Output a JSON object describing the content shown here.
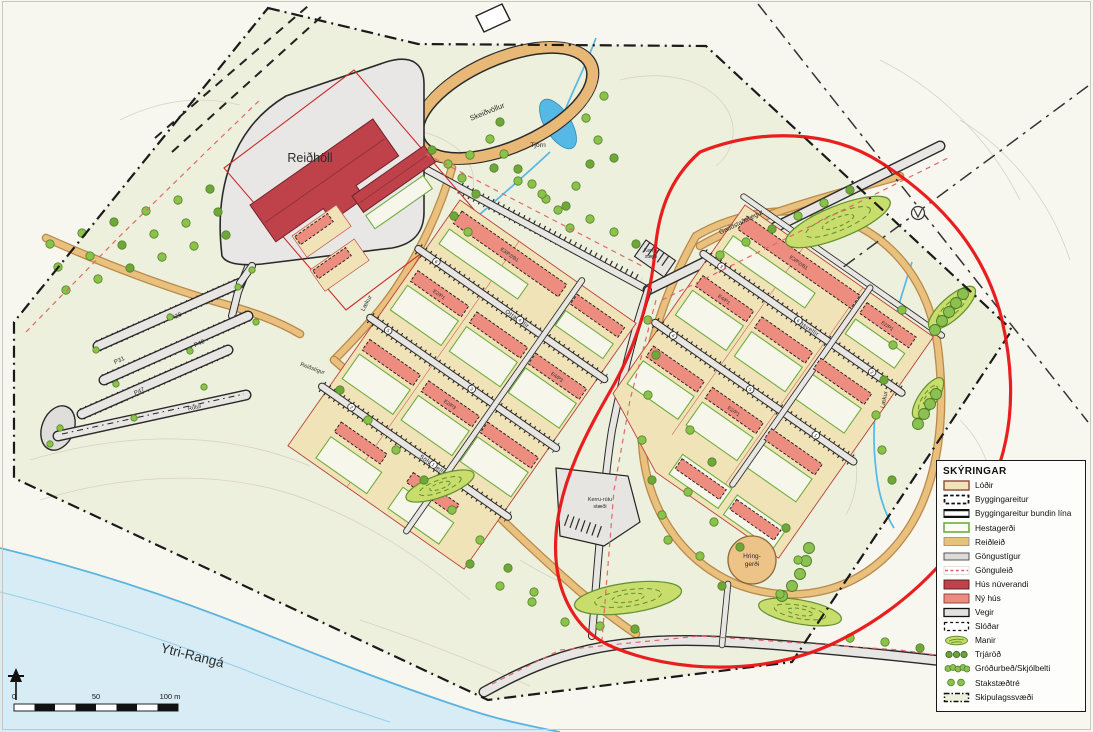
{
  "legend": {
    "title": "SKÝRINGAR",
    "items": [
      {
        "label": "Lóðir"
      },
      {
        "label": "Byggingareitur"
      },
      {
        "label": "Byggingareitur bundin lína"
      },
      {
        "label": "Hestagerði"
      },
      {
        "label": "Reiðleið"
      },
      {
        "label": "Göngustígur"
      },
      {
        "label": "Gönguleið"
      },
      {
        "label": "Hús núverandi"
      },
      {
        "label": "Ný hús"
      },
      {
        "label": "Vegir"
      },
      {
        "label": "Slóðar"
      },
      {
        "label": "Manir"
      },
      {
        "label": "Trjáröð"
      },
      {
        "label": "Gróðurbeð/Skjólbelti"
      },
      {
        "label": "Stakstæðtré"
      },
      {
        "label": "Skipulagssvæði"
      }
    ]
  },
  "map": {
    "labels": {
      "reidholl": "Reiðhöll",
      "skeidvollur": "Skeiðvöllur",
      "tjorn": "Tjörn",
      "river": "Ytri-Rangá",
      "laekur_west": "Lækur",
      "laekur_east": "Lækur",
      "hringgerdi_l1": "Hring-",
      "hringgerdi_l2": "gerði",
      "kerru_l1": "Kerru-",
      "kerru_l2": "stæði",
      "kerru_rutu_l1": "Kerru-rútu",
      "kerru_rutu_l2": "stæði",
      "main_road": "Gaddstaðavegur",
      "street_central_upper": "Ottavellir",
      "street_central_lower": "Sölvavellir",
      "street_right": "Ornsvellir",
      "riding_path": "Reiðstígur",
      "bus_road": "Rútur"
    },
    "parking": [
      "P28",
      "P31",
      "P40",
      "P47"
    ],
    "lots": {
      "central_long": "E3/P2/B1",
      "central_a": "E2/P1",
      "central_b": "E4/P3",
      "central_c": "E2/P3",
      "right_long": "E3/P2/B1",
      "right_a": "E4/P1",
      "right_b": "E2/P1",
      "right_c": "E2/P1"
    },
    "markers": [
      "1",
      "2",
      "3",
      "4",
      "5",
      "6"
    ],
    "scalebar": {
      "zero": "0",
      "fifty": "50",
      "hundred": "100 m"
    }
  },
  "colors": {
    "annotation_red": "#e51414",
    "existing_building": "#bf4149",
    "new_building": "#ec8d80",
    "lot_fill": "#f1e3b8",
    "riding_path": "#eac07e",
    "water": "#56b8e4",
    "vegetation": "#8bc34a",
    "terrain": "#edf0dc"
  }
}
